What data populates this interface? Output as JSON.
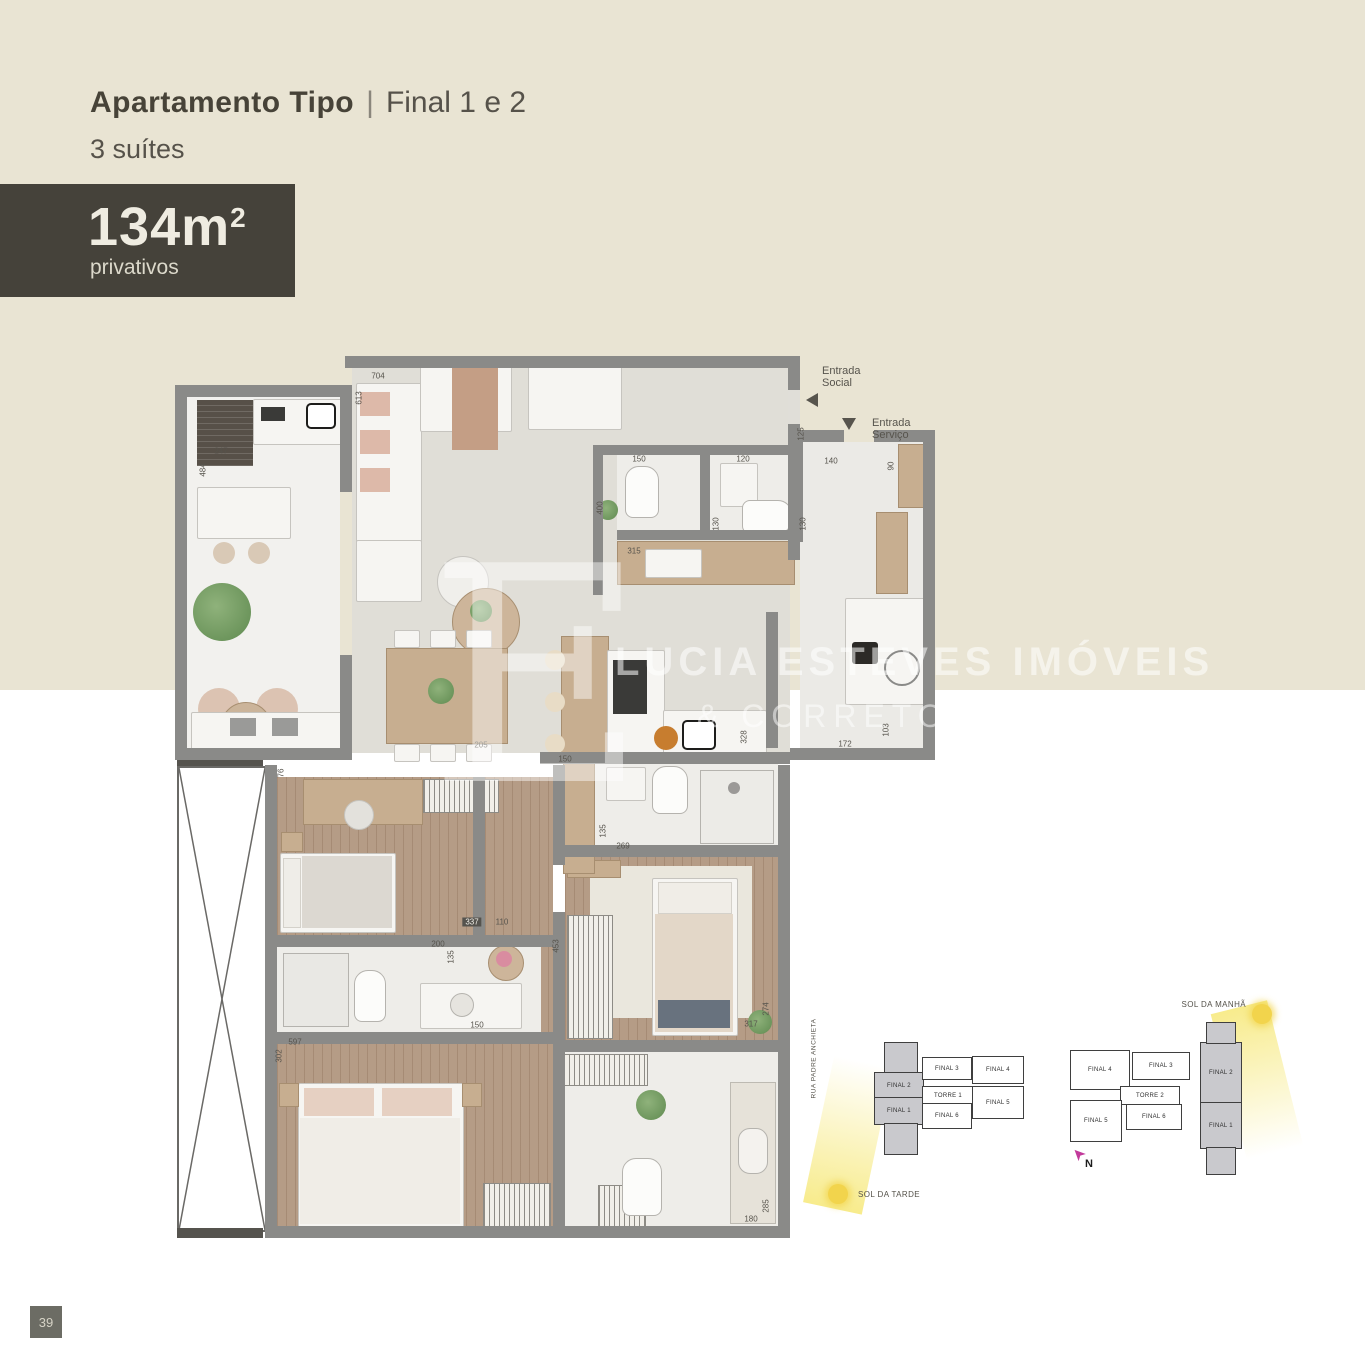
{
  "header": {
    "title_bold": "Apartamento Tipo",
    "title_sep": "|",
    "title_light": "Final 1 e 2",
    "subtitle": "3 suítes",
    "area": {
      "value": "134m",
      "sup": "2",
      "caption": "privativos"
    }
  },
  "watermark": {
    "monogram": "E",
    "line1": "LUCIA ESTEVES IMÓVEIS",
    "line2": "& CORRETORES ASSOC."
  },
  "plan": {
    "entry_social": "Entrada\nSocial",
    "entry_servico": "Entrada\nServiço",
    "dimensions": [
      {
        "t": "704",
        "x": 378,
        "y": 376
      },
      {
        "t": "613",
        "x": 359,
        "y": 398,
        "v": 1
      },
      {
        "t": "247",
        "x": 221,
        "y": 451
      },
      {
        "t": "484",
        "x": 203,
        "y": 470,
        "v": 1
      },
      {
        "t": "125",
        "x": 801,
        "y": 434,
        "v": 1
      },
      {
        "t": "140",
        "x": 831,
        "y": 461
      },
      {
        "t": "90",
        "x": 891,
        "y": 466,
        "v": 1
      },
      {
        "t": "150",
        "x": 639,
        "y": 459
      },
      {
        "t": "120",
        "x": 743,
        "y": 459
      },
      {
        "t": "400",
        "x": 600,
        "y": 508,
        "v": 1
      },
      {
        "t": "315",
        "x": 634,
        "y": 551
      },
      {
        "t": "130",
        "x": 716,
        "y": 524,
        "v": 1
      },
      {
        "t": "130",
        "x": 803,
        "y": 524,
        "v": 1
      },
      {
        "t": "205",
        "x": 481,
        "y": 745
      },
      {
        "t": "150",
        "x": 565,
        "y": 759
      },
      {
        "t": "328",
        "x": 744,
        "y": 737,
        "v": 1
      },
      {
        "t": "172",
        "x": 845,
        "y": 744
      },
      {
        "t": "103",
        "x": 886,
        "y": 730,
        "v": 1
      },
      {
        "t": "337",
        "x": 472,
        "y": 922,
        "dark": 1
      },
      {
        "t": "110",
        "x": 502,
        "y": 922
      },
      {
        "t": "200",
        "x": 438,
        "y": 944
      },
      {
        "t": "135",
        "x": 451,
        "y": 957,
        "v": 1
      },
      {
        "t": "453",
        "x": 556,
        "y": 946,
        "v": 1
      },
      {
        "t": "150",
        "x": 477,
        "y": 1025
      },
      {
        "t": "76",
        "x": 281,
        "y": 773,
        "v": 1
      },
      {
        "t": "597",
        "x": 295,
        "y": 1042
      },
      {
        "t": "302",
        "x": 279,
        "y": 1056,
        "v": 1
      },
      {
        "t": "135",
        "x": 603,
        "y": 831,
        "v": 1
      },
      {
        "t": "269",
        "x": 623,
        "y": 846
      },
      {
        "t": "274",
        "x": 766,
        "y": 1009,
        "v": 1
      },
      {
        "t": "317",
        "x": 751,
        "y": 1024
      },
      {
        "t": "180",
        "x": 751,
        "y": 1219
      },
      {
        "t": "285",
        "x": 766,
        "y": 1206,
        "v": 1
      }
    ]
  },
  "site": {
    "street": "RUA PADRE ANCHIETA",
    "sun_morning": "SOL DA MANHÃ",
    "sun_afternoon": "SOL DA TARDE",
    "north": "N",
    "tower_cells": [
      {
        "label": "",
        "x": 884,
        "y": 1042,
        "w": 32,
        "h": 30,
        "hl": 1
      },
      {
        "label": "FINAL 2",
        "x": 874,
        "y": 1072,
        "w": 48,
        "h": 25,
        "hl": 1
      },
      {
        "label": "FINAL 1",
        "x": 874,
        "y": 1097,
        "w": 48,
        "h": 26,
        "hl": 1
      },
      {
        "label": "",
        "x": 884,
        "y": 1123,
        "w": 32,
        "h": 30,
        "hl": 1
      },
      {
        "label": "FINAL 3",
        "x": 922,
        "y": 1057,
        "w": 48,
        "h": 21
      },
      {
        "label": "TORRE 1",
        "x": 922,
        "y": 1086,
        "w": 50,
        "h": 17
      },
      {
        "label": "FINAL 6",
        "x": 922,
        "y": 1103,
        "w": 48,
        "h": 24
      },
      {
        "label": "FINAL 4",
        "x": 972,
        "y": 1056,
        "w": 50,
        "h": 26
      },
      {
        "label": "FINAL 5",
        "x": 972,
        "y": 1086,
        "w": 50,
        "h": 31
      },
      {
        "label": "FINAL 4",
        "x": 1070,
        "y": 1050,
        "w": 58,
        "h": 38
      },
      {
        "label": "FINAL 3",
        "x": 1132,
        "y": 1052,
        "w": 56,
        "h": 26
      },
      {
        "label": "TORRE 2",
        "x": 1120,
        "y": 1086,
        "w": 58,
        "h": 17
      },
      {
        "label": "FINAL 5",
        "x": 1070,
        "y": 1100,
        "w": 50,
        "h": 40
      },
      {
        "label": "FINAL 6",
        "x": 1126,
        "y": 1104,
        "w": 54,
        "h": 24
      },
      {
        "label": "FINAL 2",
        "x": 1200,
        "y": 1042,
        "w": 40,
        "h": 60,
        "hl": 1
      },
      {
        "label": "FINAL 1",
        "x": 1200,
        "y": 1102,
        "w": 40,
        "h": 45,
        "hl": 1
      },
      {
        "label": "",
        "x": 1206,
        "y": 1022,
        "w": 28,
        "h": 20,
        "hl": 1
      },
      {
        "label": "",
        "x": 1206,
        "y": 1147,
        "w": 28,
        "h": 26,
        "hl": 1
      }
    ]
  },
  "page": {
    "number": "39"
  },
  "colors": {
    "beige": "#e9e4d3",
    "badge": "#45423a",
    "wall": "#8a8a88",
    "wood_floor": "#b59c86",
    "highlight_cell": "#c9c9cd",
    "sun": "#f2d44c",
    "north_arrow": "#c23a9b"
  }
}
